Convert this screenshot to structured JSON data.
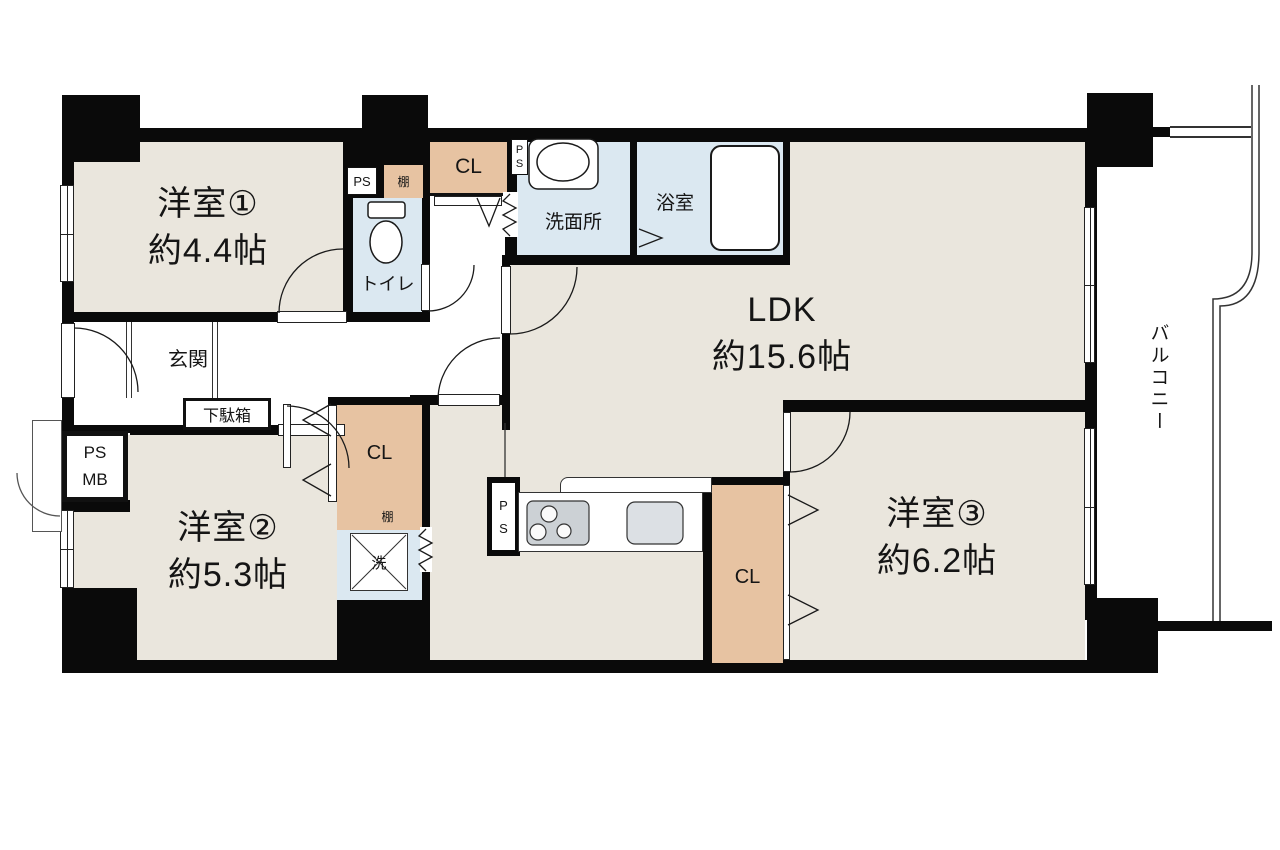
{
  "colors": {
    "wall": "#0a0a0a",
    "floor": "#eae6dd",
    "wet": "#dbe8f1",
    "closet": "#e7c3a2",
    "counter_gray": "#ccd1d5",
    "sink_gray": "#dce0e4"
  },
  "rooms": {
    "room1": {
      "name": "洋室①",
      "size": "約4.4帖"
    },
    "room2": {
      "name": "洋室②",
      "size": "約5.3帖"
    },
    "room3": {
      "name": "洋室③",
      "size": "約6.2帖"
    },
    "ldk": {
      "name": "LDK",
      "size": "約15.6帖"
    },
    "balcony": "バルコニー",
    "entrance": "玄関",
    "toilet": "トイレ",
    "washroom": "洗面所",
    "bathroom": "浴室"
  },
  "fixtures": {
    "closet": "CL",
    "shelf": "棚",
    "shoe_cabinet": "下駄箱",
    "washer": "洗",
    "pipe_space": "PS",
    "meter_box": "MB",
    "ps_vertical": {
      "p": "P",
      "s": "S"
    }
  }
}
